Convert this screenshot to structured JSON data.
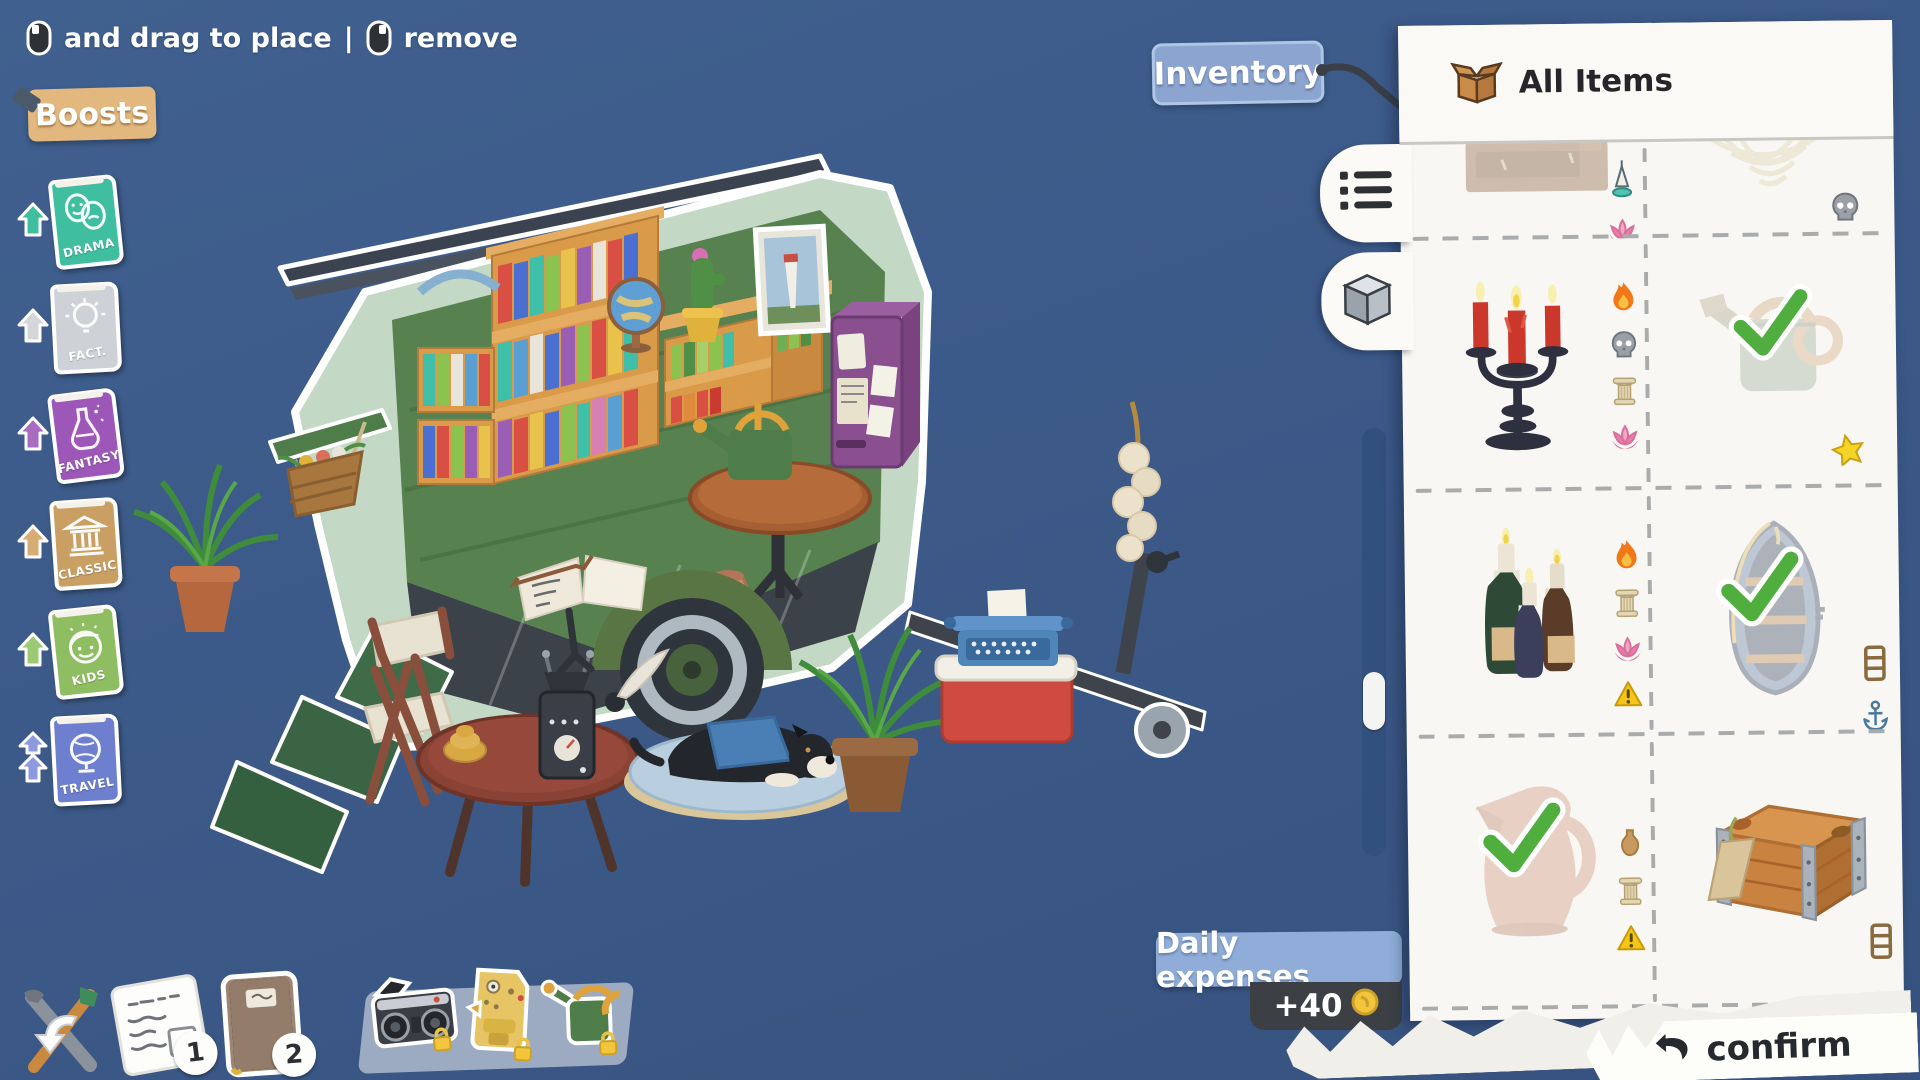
{
  "hint_bar": {
    "drag": "and drag to place",
    "sep": "|",
    "remove": "remove",
    "icons": [
      "left-mouse-button-icon",
      "right-mouse-button-icon"
    ]
  },
  "boosts": {
    "title": "Boosts",
    "books": [
      {
        "label": "DRAMA",
        "color": "#3fbfa0",
        "doodle": "theater-masks-icon",
        "arrows": 1
      },
      {
        "label": "FACT.",
        "color": "#ced2d6",
        "doodle": "lightbulb-icon",
        "arrows": 1
      },
      {
        "label": "FANTASY",
        "color": "#9c57b8",
        "doodle": "potion-flask-icon",
        "arrows": 1
      },
      {
        "label": "CLASSIC",
        "color": "#c99f63",
        "doodle": "greek-temple-icon",
        "arrows": 1
      },
      {
        "label": "KIDS",
        "color": "#8fbe62",
        "doodle": "child-face-icon",
        "arrows": 1
      },
      {
        "label": "TRAVEL",
        "color": "#6f7fd0",
        "doodle": "globe-icon",
        "arrows": 2
      }
    ]
  },
  "inventory": {
    "tag_label": "Inventory",
    "title": "All Items",
    "title_icon": "open-box-icon",
    "tabs": [
      {
        "icon": "list-view-icon",
        "active": true
      },
      {
        "icon": "cube-view-icon",
        "active": false
      }
    ],
    "scrollbar": {
      "position": "58%"
    },
    "rows": [
      {
        "left": {
          "item": "wall-shelf",
          "state": "placed-in-scene",
          "icons": [
            "vase-icon",
            "incense-icon",
            "lotus-icon"
          ]
        },
        "right": {
          "item": "hanging-basket",
          "state": "placed-in-scene",
          "icons": [
            "skull-icon"
          ]
        }
      },
      {
        "left": {
          "item": "candelabra",
          "state": "available",
          "icons": [
            "fire-icon",
            "skull-icon",
            "column-icon",
            "lotus-icon"
          ]
        },
        "right": {
          "item": "watering-can",
          "state": "placed-selected",
          "check": true,
          "icons": [
            "star-icon"
          ]
        }
      },
      {
        "left": {
          "item": "bottle-candles",
          "state": "available",
          "icons": [
            "fire-icon",
            "column-icon",
            "lotus-icon",
            "warning-icon"
          ]
        },
        "right": {
          "item": "boat-shelf",
          "state": "placed-selected",
          "check": true,
          "icons": [
            "shelf-icon",
            "anchor-icon"
          ]
        }
      },
      {
        "left": {
          "item": "pitcher",
          "state": "placed-selected",
          "check": true,
          "icons": [
            "vase-icon",
            "column-icon",
            "warning-icon"
          ]
        },
        "right": {
          "item": "wooden-crate",
          "state": "available",
          "icons": [
            "shelf-icon"
          ]
        }
      }
    ]
  },
  "expenses": {
    "label": "Daily expenses",
    "amount": "+40",
    "amount_icon": "coin-icon"
  },
  "confirm_label": "confirm",
  "quickbar": {
    "tools_icon": "tools-undo-icon",
    "pages": [
      {
        "badge": "1",
        "icon": "notes-page-icon"
      },
      {
        "badge": "2",
        "icon": "journal-icon"
      }
    ],
    "stickers": [
      {
        "icon": "boombox-sticker",
        "locked": true
      },
      {
        "icon": "coffee-machine-sticker",
        "locked": true
      },
      {
        "icon": "watering-can-sticker",
        "locked": true
      }
    ]
  },
  "scene": {
    "items": [
      "caravan-bookshop",
      "roof-slats",
      "bookshelf-large",
      "bookshelf-cubes",
      "globe",
      "cactus",
      "lighthouse-picture",
      "note-dispenser",
      "round-table-inside",
      "watering-can",
      "floor-pitcher",
      "wheel",
      "ramp-steps",
      "hanging-flower-basket",
      "garlic-strand",
      "trailer-hitch",
      "fern-left",
      "camp-chair",
      "outdoor-table",
      "coffee-grinder",
      "open-book-stand",
      "dog-on-cushion",
      "fern-right",
      "typewriter-on-cooler"
    ]
  },
  "colors": {
    "background": "#3d5c8f",
    "panel": "#f8f7f3",
    "tag_blue": "#8fadd8",
    "sign_tan": "#e2b87f",
    "trailer_mint": "#c3d8c5",
    "interior_green": "#57824f",
    "check_green": "#4fae3d",
    "coin_gold": "#f2c53d"
  }
}
